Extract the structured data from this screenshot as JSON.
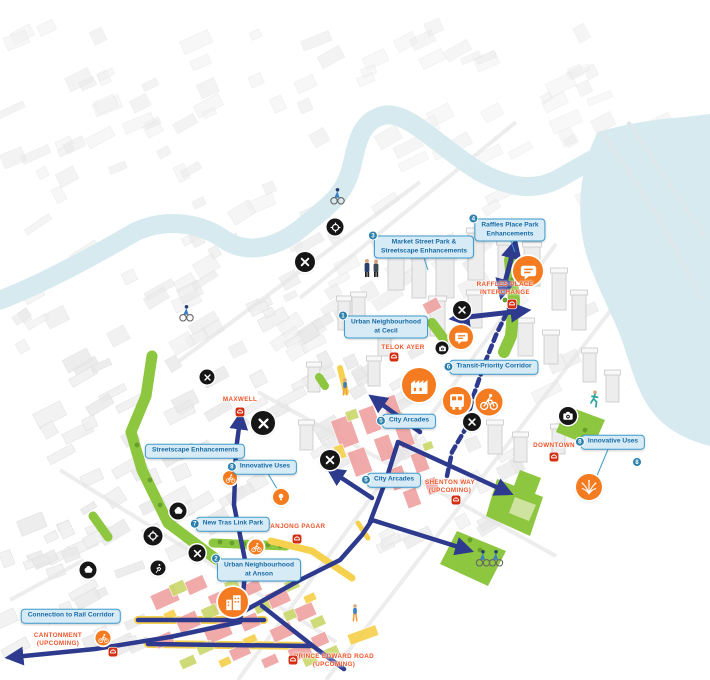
{
  "colors": {
    "water": "#d6eaef",
    "park": "#8dc63f",
    "park_light": "#cfe3a0",
    "tree": "#679f2d",
    "corridor_navy": "#2d3a8e",
    "poi_orange": "#f47b20",
    "poi_black": "#161616",
    "label_fill": "#d7ebf7",
    "label_border": "#3f9cce",
    "label_text": "#176ba5",
    "badge_teal": "#2c80ae",
    "station_text": "#f0552a",
    "mrt_red": "#d42e12",
    "zone_pink": "#f0a3a3",
    "zone_lime": "#ccd96d",
    "zone_yellow": "#f6d14f"
  },
  "callouts": [
    {
      "num": "3",
      "text": "Market Street Park &\nStreetscape Enhancements",
      "x": 424,
      "y": 247
    },
    {
      "num": "4",
      "text": "Raffles Place Park\nEnhancements",
      "x": 510,
      "y": 230
    },
    {
      "num": "1",
      "text": "Urban Neighbourhood\nat Cecil",
      "x": 386,
      "y": 327
    },
    {
      "num": "6",
      "text": "Transit-Priority Corridor",
      "x": 494,
      "y": 367
    },
    {
      "num": "5",
      "text": "City Arcades",
      "x": 409,
      "y": 421
    },
    {
      "num": "5",
      "text": "City Arcades",
      "x": 394,
      "y": 480
    },
    {
      "num": "8",
      "text": "Innovative Uses",
      "x": 265,
      "y": 467
    },
    {
      "num": "8",
      "text": "Innovative Uses",
      "x": 613,
      "y": 442
    },
    {
      "num": "",
      "text": "Streetscape Enhancements",
      "x": 195,
      "y": 451
    },
    {
      "num": "7",
      "text": "New Tras Link Park",
      "x": 233,
      "y": 524
    },
    {
      "num": "2",
      "text": "Urban Neighbourhood\nat Anson",
      "x": 259,
      "y": 570
    },
    {
      "num": "",
      "text": "Connection to Rail Corridor",
      "x": 71,
      "y": 616
    }
  ],
  "floating_badges": [
    {
      "num": "8",
      "x": 637,
      "y": 462
    }
  ],
  "stations": [
    {
      "name": "RAFFLES PLACE\nINTERCHANGE",
      "x": 505,
      "y": 289,
      "icon_x": 512,
      "icon_y": 304
    },
    {
      "name": "TELOK AYER",
      "x": 403,
      "y": 348,
      "icon_x": 394,
      "icon_y": 357
    },
    {
      "name": "MAXWELL",
      "x": 240,
      "y": 400,
      "icon_x": 240,
      "icon_y": 412
    },
    {
      "name": "DOWNTOWN",
      "x": 554,
      "y": 446,
      "icon_x": 554,
      "icon_y": 457
    },
    {
      "name": "SHENTON WAY\n(UPCOMING)",
      "x": 450,
      "y": 487,
      "icon_x": 456,
      "icon_y": 500
    },
    {
      "name": "TANJONG PAGAR",
      "x": 296,
      "y": 527,
      "icon_x": 297,
      "icon_y": 539
    },
    {
      "name": "CANTONMENT\n(UPCOMING)",
      "x": 58,
      "y": 640,
      "icon_x": 113,
      "icon_y": 652
    },
    {
      "name": "PRINCE EDWARD ROAD\n(UPCOMING)",
      "x": 334,
      "y": 661,
      "icon_x": 293,
      "icon_y": 660
    }
  ],
  "orange_pois": [
    {
      "icon": "speech-bubble",
      "x": 528,
      "y": 271,
      "d": 30
    },
    {
      "icon": "speech-bubble",
      "x": 461,
      "y": 337,
      "d": 24
    },
    {
      "icon": "shophouses",
      "x": 419,
      "y": 385,
      "d": 34
    },
    {
      "icon": "bus",
      "x": 457,
      "y": 401,
      "d": 28
    },
    {
      "icon": "cyclist",
      "x": 489,
      "y": 402,
      "d": 27
    },
    {
      "icon": "fireworks",
      "x": 589,
      "y": 487,
      "d": 26
    },
    {
      "icon": "buildings",
      "x": 233,
      "y": 602,
      "d": 30
    },
    {
      "icon": "cyclist",
      "x": 230,
      "y": 478,
      "d": 14
    },
    {
      "icon": "lightbulb",
      "x": 281,
      "y": 497,
      "d": 16
    },
    {
      "icon": "cyclist",
      "x": 256,
      "y": 547,
      "d": 15
    },
    {
      "icon": "cyclist",
      "x": 103,
      "y": 638,
      "d": 15
    }
  ],
  "black_pois": [
    {
      "icon": "crossed-utensils",
      "x": 305,
      "y": 262,
      "d": 20
    },
    {
      "icon": "target",
      "x": 335,
      "y": 227,
      "d": 17
    },
    {
      "icon": "crossed-utensils",
      "x": 207,
      "y": 377,
      "d": 15
    },
    {
      "icon": "crossed-utensils",
      "x": 263,
      "y": 423,
      "d": 24
    },
    {
      "icon": "crossed-utensils",
      "x": 330,
      "y": 460,
      "d": 20
    },
    {
      "icon": "crossed-utensils",
      "x": 472,
      "y": 422,
      "d": 18
    },
    {
      "icon": "crossed-utensils",
      "x": 462,
      "y": 310,
      "d": 18
    },
    {
      "icon": "camera",
      "x": 442,
      "y": 348,
      "d": 13
    },
    {
      "icon": "camera",
      "x": 568,
      "y": 416,
      "d": 18
    },
    {
      "icon": "tree-canopy",
      "x": 178,
      "y": 511,
      "d": 17
    },
    {
      "icon": "target",
      "x": 153,
      "y": 536,
      "d": 19
    },
    {
      "icon": "crossed-utensils",
      "x": 197,
      "y": 553,
      "d": 17
    },
    {
      "icon": "runner",
      "x": 158,
      "y": 568,
      "d": 15
    },
    {
      "icon": "tree-canopy",
      "x": 88,
      "y": 570,
      "d": 17
    }
  ],
  "figures": [
    {
      "type": "cyclist",
      "x": 337,
      "y": 203
    },
    {
      "type": "cyclist",
      "x": 186,
      "y": 320
    },
    {
      "type": "businessmen",
      "x": 372,
      "y": 276
    },
    {
      "type": "pedestrian",
      "x": 345,
      "y": 394
    },
    {
      "type": "runner",
      "x": 594,
      "y": 406
    },
    {
      "type": "cyclist-pair",
      "x": 489,
      "y": 565
    },
    {
      "type": "pedestrian",
      "x": 355,
      "y": 620
    }
  ]
}
